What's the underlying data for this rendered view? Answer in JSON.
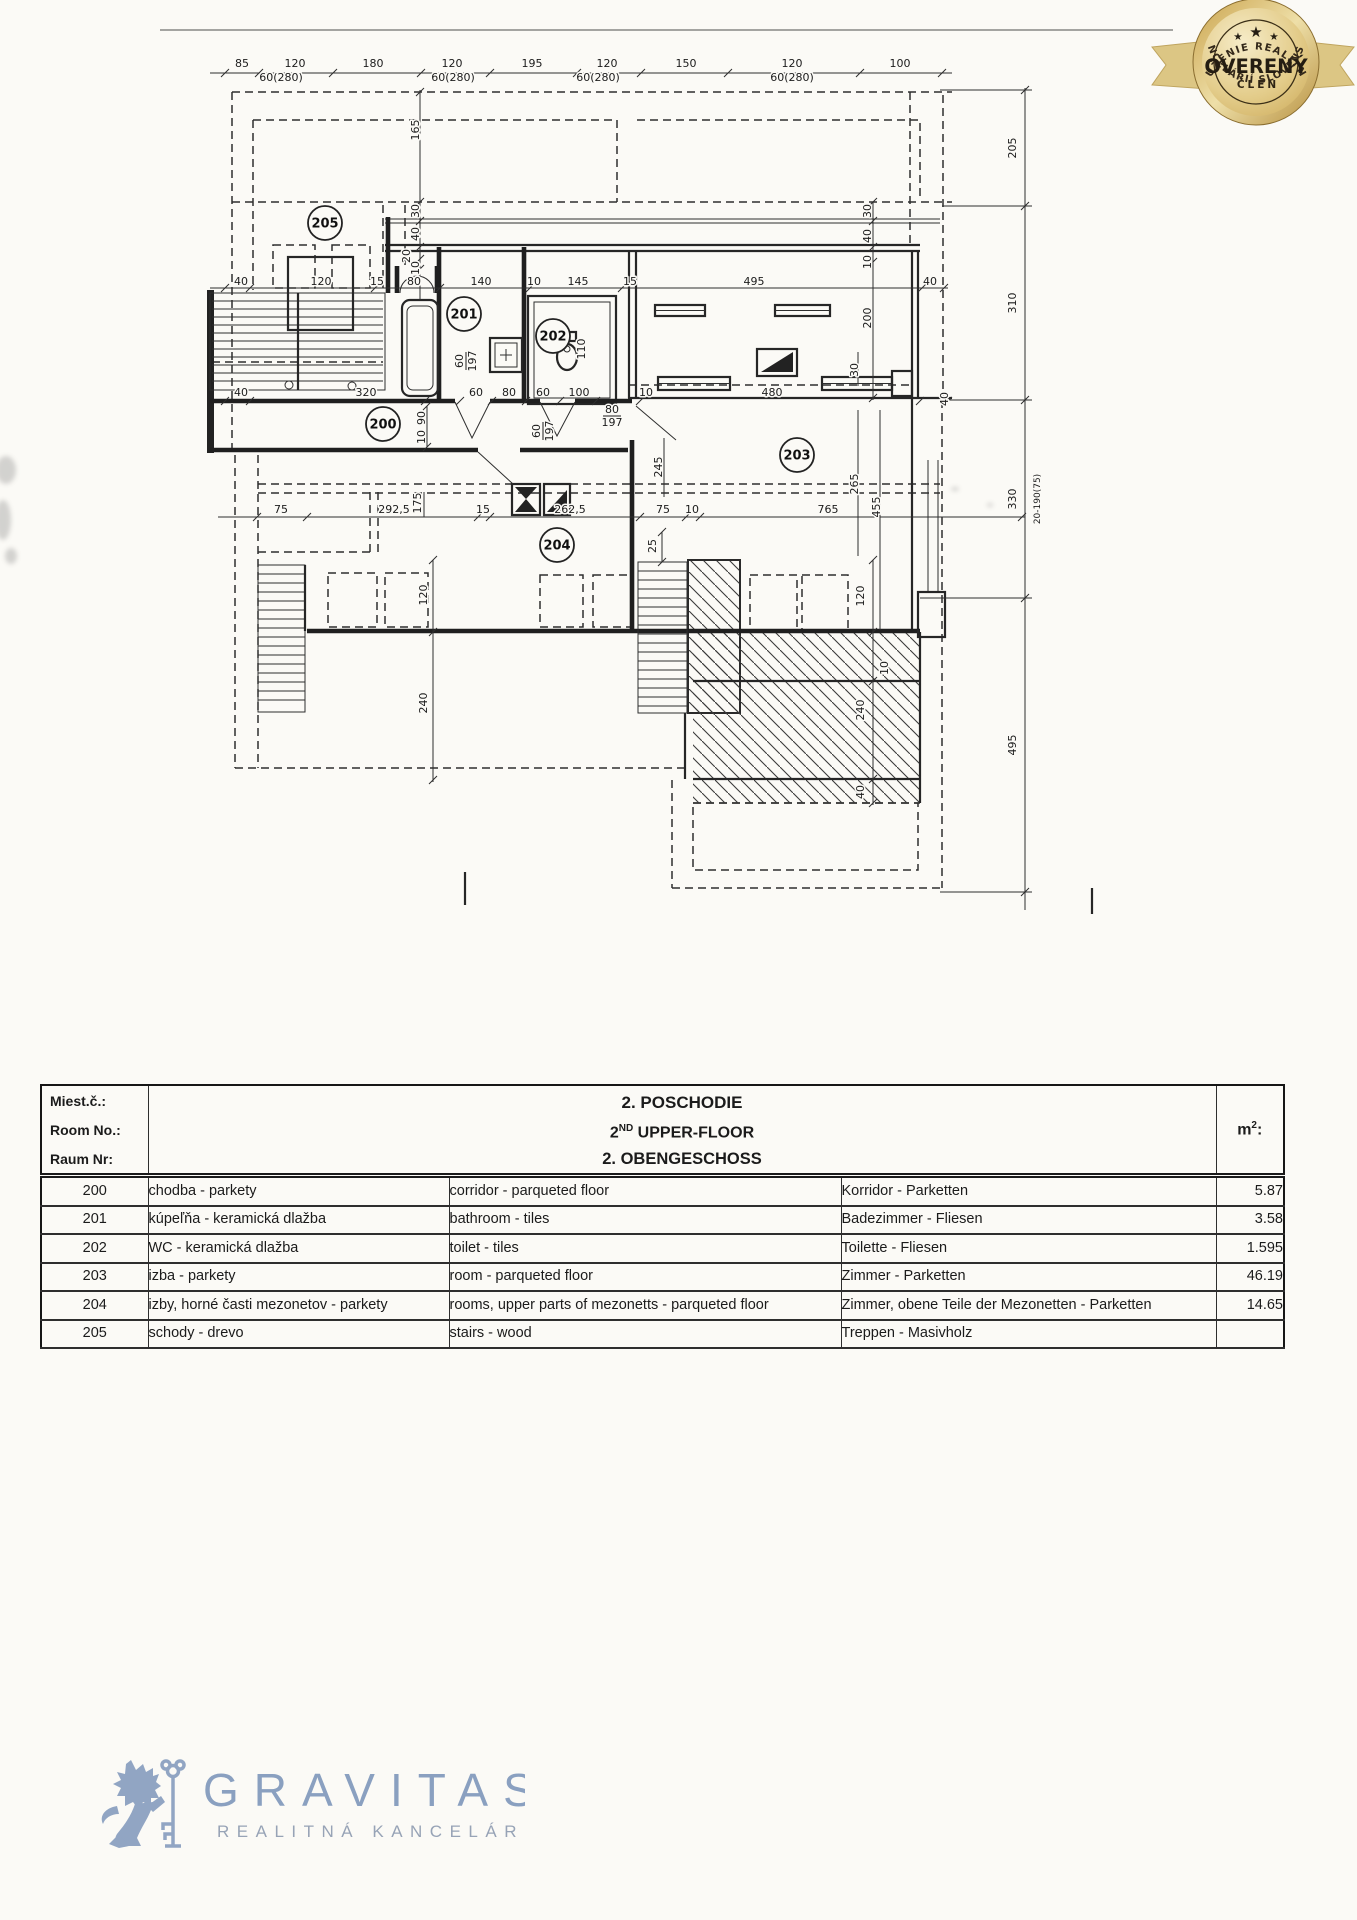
{
  "badge": {
    "arc_top": "ZDRUŽENIE REALITNÝCH",
    "star_big": "★",
    "star_small_left": "★",
    "star_small_right": "★",
    "title": "OVERENÝ",
    "subtitle": "ČLEN",
    "arc_bottom": "KANCELÁRIÍ SLOVENSKA",
    "gold": "#caa34d",
    "gold_light": "#f0e0ac",
    "ribbon": "#dcc684",
    "text_dark": "#2e2414"
  },
  "plan": {
    "rooms": [
      {
        "n": "200",
        "x": 383,
        "y": 424
      },
      {
        "n": "201",
        "x": 464,
        "y": 314
      },
      {
        "n": "202",
        "x": 553,
        "y": 336
      },
      {
        "n": "203",
        "x": 797,
        "y": 455
      },
      {
        "n": "204",
        "x": 557,
        "y": 545
      },
      {
        "n": "205",
        "x": 325,
        "y": 223
      }
    ],
    "dims": [
      {
        "t": "85",
        "x": 242,
        "y": 67
      },
      {
        "t": "120",
        "x": 295,
        "y": 67
      },
      {
        "t": "180",
        "x": 373,
        "y": 67
      },
      {
        "t": "120",
        "x": 452,
        "y": 67
      },
      {
        "t": "195",
        "x": 532,
        "y": 67
      },
      {
        "t": "120",
        "x": 607,
        "y": 67
      },
      {
        "t": "150",
        "x": 686,
        "y": 67
      },
      {
        "t": "120",
        "x": 792,
        "y": 67
      },
      {
        "t": "100",
        "x": 900,
        "y": 67
      },
      {
        "t": "60(280)",
        "x": 281,
        "y": 81
      },
      {
        "t": "60(280)",
        "x": 453,
        "y": 81
      },
      {
        "t": "60(280)",
        "x": 598,
        "y": 81
      },
      {
        "t": "60(280)",
        "x": 792,
        "y": 81
      },
      {
        "t": "40",
        "x": 241,
        "y": 285
      },
      {
        "t": "120",
        "x": 321,
        "y": 285
      },
      {
        "t": "15",
        "x": 377,
        "y": 285
      },
      {
        "t": "80",
        "x": 414,
        "y": 285
      },
      {
        "t": "140",
        "x": 481,
        "y": 285
      },
      {
        "t": "10",
        "x": 534,
        "y": 285
      },
      {
        "t": "145",
        "x": 578,
        "y": 285
      },
      {
        "t": "15",
        "x": 630,
        "y": 285
      },
      {
        "t": "495",
        "x": 754,
        "y": 285
      },
      {
        "t": "40",
        "x": 930,
        "y": 285
      },
      {
        "t": "40",
        "x": 241,
        "y": 396
      },
      {
        "t": "320",
        "x": 366,
        "y": 396
      },
      {
        "t": "60",
        "x": 476,
        "y": 396
      },
      {
        "t": "80",
        "x": 509,
        "y": 396
      },
      {
        "t": "60",
        "x": 543,
        "y": 396
      },
      {
        "t": "100",
        "x": 579,
        "y": 396
      },
      {
        "t": "10",
        "x": 646,
        "y": 396
      },
      {
        "t": "480",
        "x": 772,
        "y": 396
      },
      {
        "t": "75",
        "x": 281,
        "y": 513
      },
      {
        "t": "292,5",
        "x": 394,
        "y": 513
      },
      {
        "t": "15",
        "x": 483,
        "y": 513
      },
      {
        "t": "262,5",
        "x": 570,
        "y": 513
      },
      {
        "t": "75",
        "x": 663,
        "y": 513
      },
      {
        "t": "10",
        "x": 692,
        "y": 513
      },
      {
        "t": "765",
        "x": 828,
        "y": 513
      },
      {
        "t": "205",
        "x": 1016,
        "y": 148,
        "r": 1
      },
      {
        "t": "310",
        "x": 1016,
        "y": 303,
        "r": 1
      },
      {
        "t": "330",
        "x": 1016,
        "y": 499,
        "r": 1
      },
      {
        "t": "20-190(75)",
        "x": 1040,
        "y": 499,
        "r": 1,
        "s": 9
      },
      {
        "t": "495",
        "x": 1016,
        "y": 745,
        "r": 1
      },
      {
        "t": "165",
        "x": 419,
        "y": 130,
        "r": 1
      },
      {
        "t": "30",
        "x": 419,
        "y": 211,
        "r": 1
      },
      {
        "t": "40",
        "x": 419,
        "y": 234,
        "r": 1
      },
      {
        "t": "20",
        "x": 410,
        "y": 256,
        "r": 1
      },
      {
        "t": "10",
        "x": 419,
        "y": 268,
        "r": 1
      },
      {
        "t": "30",
        "x": 871,
        "y": 211,
        "r": 1
      },
      {
        "t": "40",
        "x": 871,
        "y": 236,
        "r": 1
      },
      {
        "t": "10",
        "x": 871,
        "y": 262,
        "r": 1
      },
      {
        "t": "200",
        "x": 871,
        "y": 318,
        "r": 1
      },
      {
        "t": "90",
        "x": 425,
        "y": 418,
        "r": 1
      },
      {
        "t": "10",
        "x": 425,
        "y": 437,
        "r": 1
      },
      {
        "t": "175",
        "x": 421,
        "y": 503,
        "r": 1
      },
      {
        "t": "120",
        "x": 427,
        "y": 595,
        "r": 1
      },
      {
        "t": "240",
        "x": 427,
        "y": 703,
        "r": 1
      },
      {
        "t": "120",
        "x": 864,
        "y": 596,
        "r": 1
      },
      {
        "t": "240",
        "x": 864,
        "y": 710,
        "r": 1
      },
      {
        "t": "40",
        "x": 864,
        "y": 792,
        "r": 1
      },
      {
        "t": "10",
        "x": 888,
        "y": 668,
        "r": 1
      },
      {
        "t": "245",
        "x": 662,
        "y": 467,
        "r": 1
      },
      {
        "t": "265",
        "x": 858,
        "y": 484,
        "r": 1
      },
      {
        "t": "455",
        "x": 880,
        "y": 507,
        "r": 1
      },
      {
        "t": "30",
        "x": 858,
        "y": 370,
        "r": 1
      },
      {
        "t": "25",
        "x": 656,
        "y": 546,
        "r": 1
      },
      {
        "t": "110",
        "x": 585,
        "y": 349,
        "r": 1
      },
      {
        "t": "40",
        "x": 948,
        "y": 399,
        "r": 1
      },
      {
        "t": "60",
        "t2": "197",
        "x": 466,
        "y": 361,
        "r": 1
      },
      {
        "t": "60",
        "t2": "197",
        "x": 543,
        "y": 431,
        "r": 1
      },
      {
        "t": "80",
        "t2": "197",
        "x": 612,
        "y": 416
      }
    ]
  },
  "table": {
    "header": {
      "left": [
        "Miest.č.:",
        "Room No.:",
        "Raum Nr:"
      ],
      "center_line1": "2. POSCHODIE",
      "center_line2_base": "2",
      "center_line2_sup": "ND",
      "center_line2_rest": " UPPER-FLOOR",
      "center_line3": "2. OBENGESCHOSS",
      "unit_base": "m",
      "unit_sup": "2",
      "unit_colon": ":"
    },
    "rows": [
      {
        "no": "200",
        "sk": "chodba - parkety",
        "en": "corridor - parqueted floor",
        "de": "Korridor - Parketten",
        "m2": "5.87"
      },
      {
        "no": "201",
        "sk": "kúpeľňa - keramická dlažba",
        "en": "bathroom - tiles",
        "de": "Badezimmer - Fliesen",
        "m2": "3.58"
      },
      {
        "no": "202",
        "sk": "WC - keramická dlažba",
        "en": "toilet - tiles",
        "de": "Toilette - Fliesen",
        "m2": "1.595"
      },
      {
        "no": "203",
        "sk": "izba - parkety",
        "en": "room - parqueted floor",
        "de": "Zimmer - Parketten",
        "m2": "46.19"
      },
      {
        "no": "204",
        "sk": "izby, horné časti mezonetov - parkety",
        "en": "rooms, upper parts of mezonetts - parqueted floor",
        "de": "Zimmer, obene Teile der Mezonetten - Parketten",
        "m2": "14.65"
      },
      {
        "no": "205",
        "sk": "schody - drevo",
        "en": "stairs - wood",
        "de": "Treppen - Masivholz",
        "m2": ""
      }
    ]
  },
  "footer": {
    "brand": "GRAVITAS",
    "tagline": "REALITNÁ KANCELÁRIA",
    "brand_color": "#8aa0c0"
  }
}
